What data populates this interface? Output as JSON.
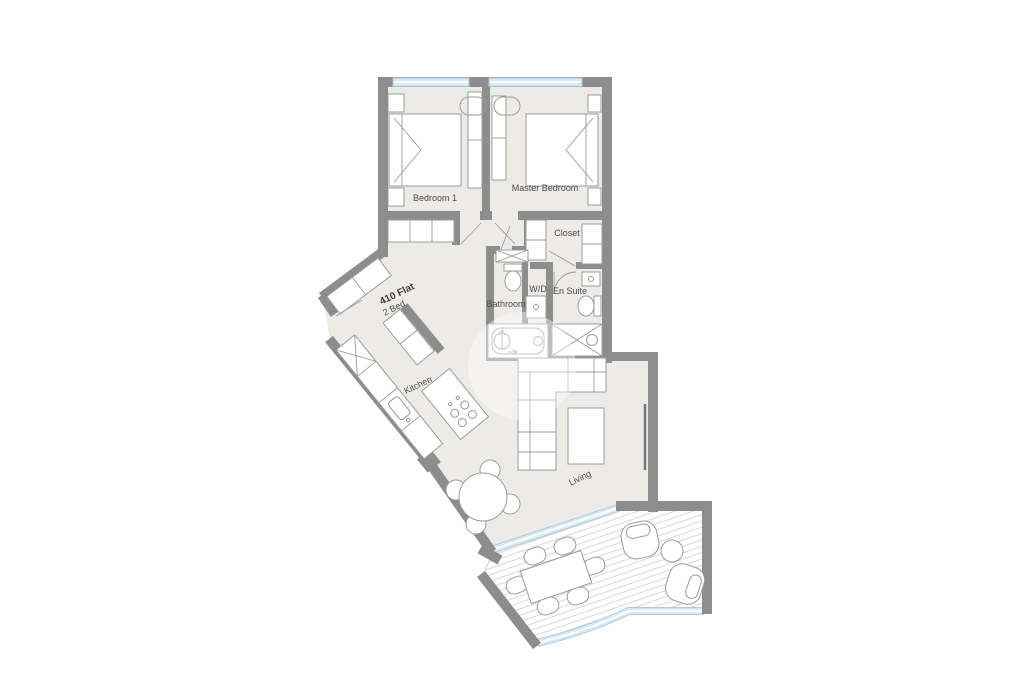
{
  "plan": {
    "type": "floor-plan",
    "labels": {
      "flat_name": "410 Flat",
      "flat_type": "2 Bed",
      "bedroom1": "Bedroom 1",
      "master_bedroom": "Master Bedroom",
      "closet": "Closet",
      "wd": "W/D",
      "en_suite": "En Suite",
      "bathroom": "Bathroom",
      "kitchen": "Kitchen",
      "living": "Living"
    },
    "colors": {
      "wall": "#8d8d8d",
      "floor": "#edebe7",
      "window_glass": "#d9e9f3",
      "window_edge": "#aecbdc",
      "furniture_line": "#9b9b99",
      "deck_hatch": "#dcd8d2",
      "label_text": "#4c4c4c"
    }
  }
}
